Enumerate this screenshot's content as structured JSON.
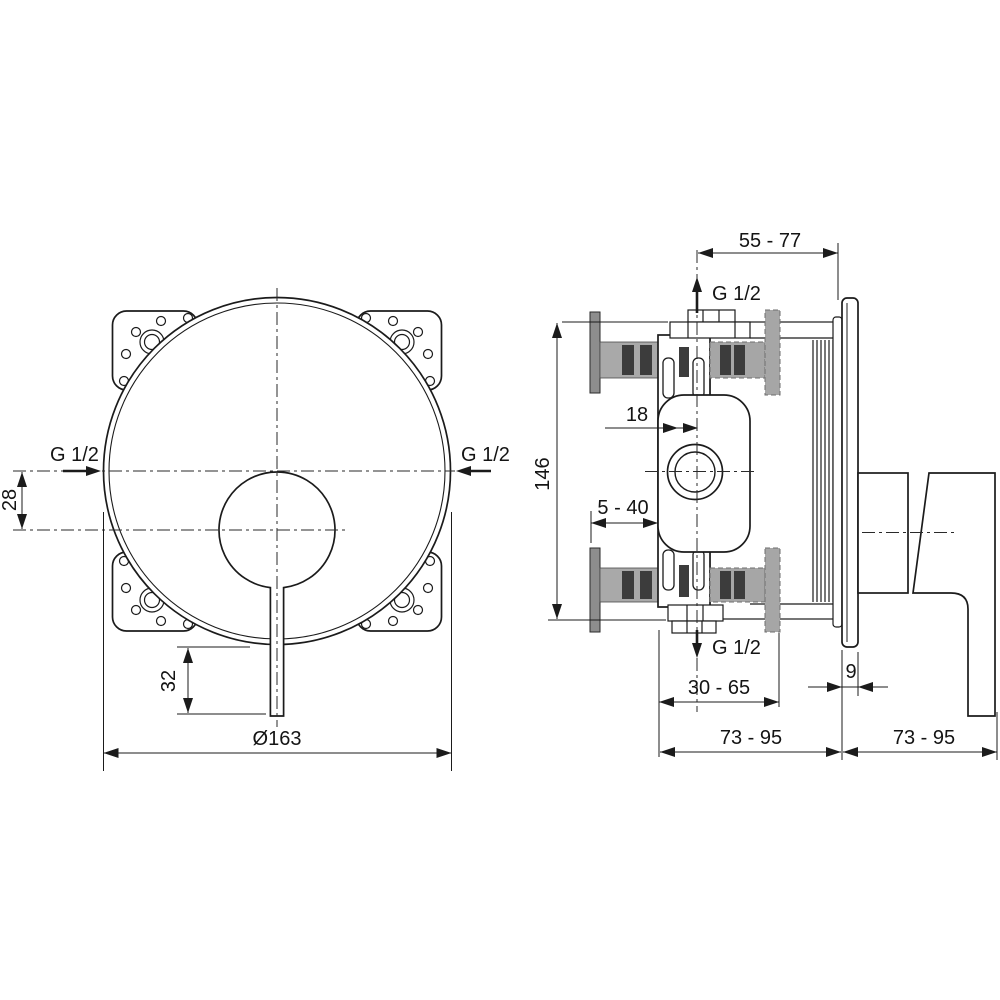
{
  "front_view": {
    "inlet_left_label": "G 1/2",
    "inlet_right_label": "G 1/2",
    "dim_inlet_offset": "28",
    "dim_handle_length": "32",
    "dim_plate_diameter": "Ø163"
  },
  "side_view": {
    "dim_outlet_to_wall": "55 - 77",
    "outlet_top_label": "G 1/2",
    "dim_body_height": "146",
    "dim_center_depth": "18",
    "dim_min_depth": "5 - 40",
    "outlet_bottom_label": "G 1/2",
    "dim_rough_in_depth": "30 - 65",
    "dim_plate_thickness": "9",
    "dim_total_depth_wall": "73 - 95",
    "dim_total_depth_front": "73 - 95"
  }
}
